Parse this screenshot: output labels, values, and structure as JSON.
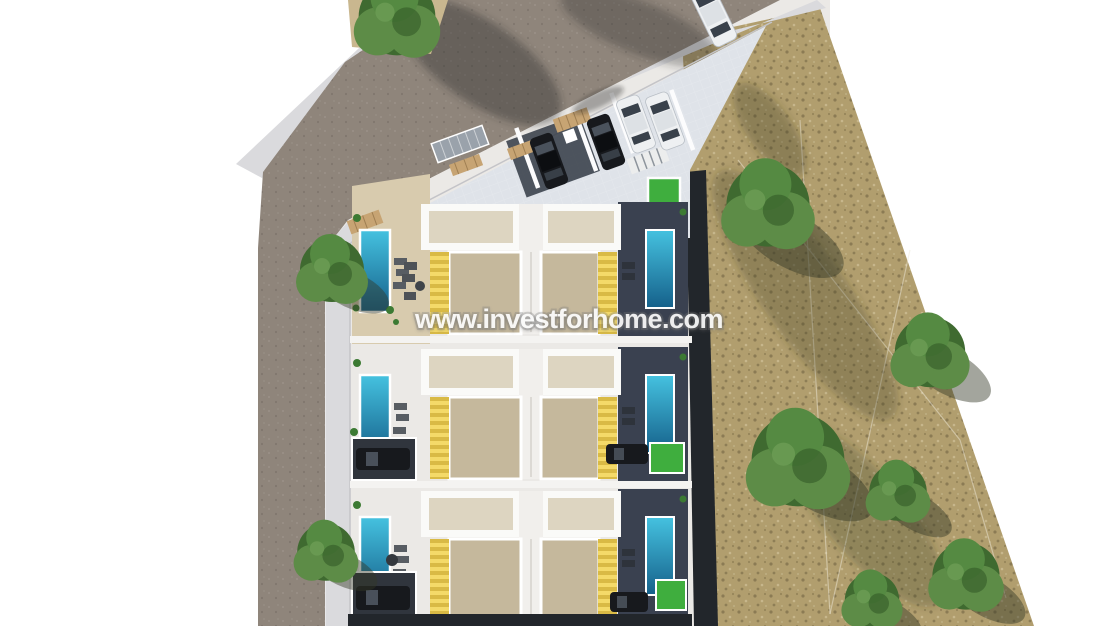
{
  "scene": {
    "description": "Aerial 3D render of a residential development: three rows of paired villas with private pools and yellow awnings, entrance parking court with cars, access roads with sidewalks, and an adjacent dry field with green trees",
    "watermark": {
      "text": "www.investforhome.com"
    }
  },
  "colors": {
    "background": "#ffffff",
    "road": "#8f857b",
    "sidewalk": "#dadadd",
    "plot_paving": "#ebe9e6",
    "entrance_paving": "#dfe3e9",
    "sand_terrace": "#d8cbae",
    "dirt_patch": "#c9b78f",
    "courtyard": "#c5b89c",
    "roof_white": "#fafaf8",
    "roof_inner": "#ddd5c1",
    "awning_yellow": "#f4da69",
    "awning_yellow_dark": "#d9ba45",
    "pool_light": "#45c2e0",
    "pool_dark": "#15608a",
    "deck_dark": "#3a4150",
    "boundary_wall": "#22262b",
    "terrain": "#b19e6e",
    "tree_green": "#5d8c47",
    "tree_green_dark": "#3f6a30",
    "grass_green": "#3fae3e",
    "car_dark": "#17191d",
    "car_white": "#eef0f2",
    "wood_tan": "#c7a473",
    "solar_grey": "#9aa2ab",
    "watermark_text": "#fbfbfb"
  }
}
